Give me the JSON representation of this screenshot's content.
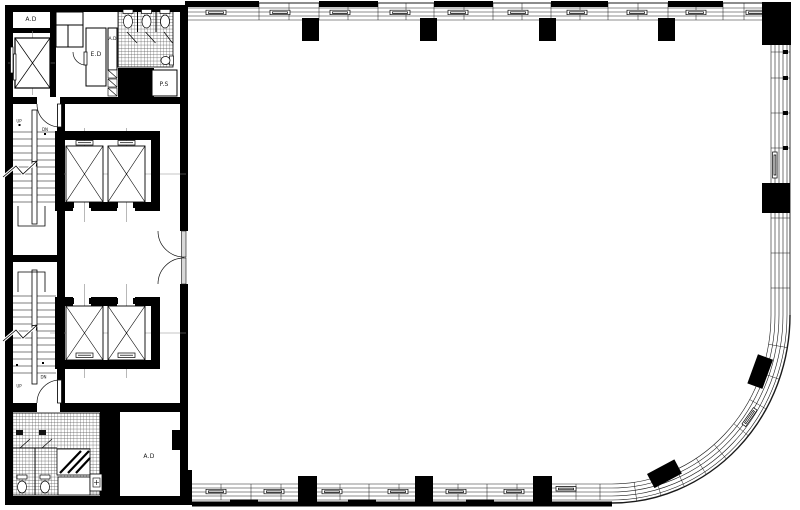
{
  "drawing": {
    "type": "architectural floor plan",
    "labels": {
      "room_ad_top_left": "A.D",
      "room_ed": "E.D",
      "room_ad_duct": "A.D",
      "room_ps": "P.S",
      "room_ad_bottom": "A.D",
      "stair_upper_up": "UP",
      "stair_upper_dn": "DN",
      "stair_lower_dn": "DN",
      "stair_lower_up": "UP"
    },
    "colors": {
      "wall": "#000000",
      "line": "#1a1a1a",
      "centerline": "#8a8a8a",
      "background": "#ffffff"
    }
  }
}
